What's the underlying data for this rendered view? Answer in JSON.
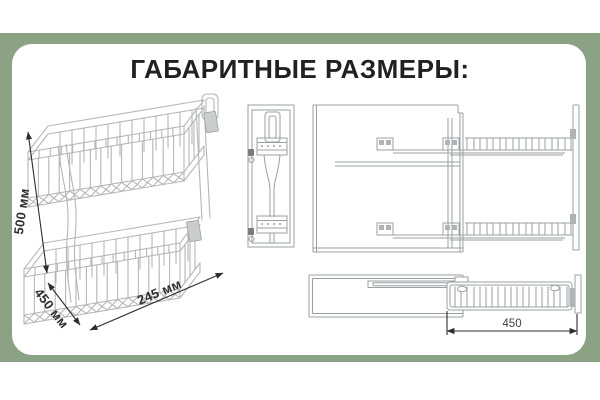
{
  "title": "ГАБАРИТНЫЕ РАЗМЕРЫ:",
  "dimensions": {
    "height": "500 мм",
    "depth": "450 мм",
    "width": "245 мм",
    "pullout_extension": "450"
  },
  "colors": {
    "frame": "#8CA284",
    "card": "#FFFFFF",
    "title_text": "#212121",
    "art_line": "#B4B7B9",
    "tech_line": "#9AA0A2",
    "dim_line": "#2E2E2E",
    "bracket_fill": "#C9CDCE",
    "hatch_fill": "#AEB3B5"
  }
}
